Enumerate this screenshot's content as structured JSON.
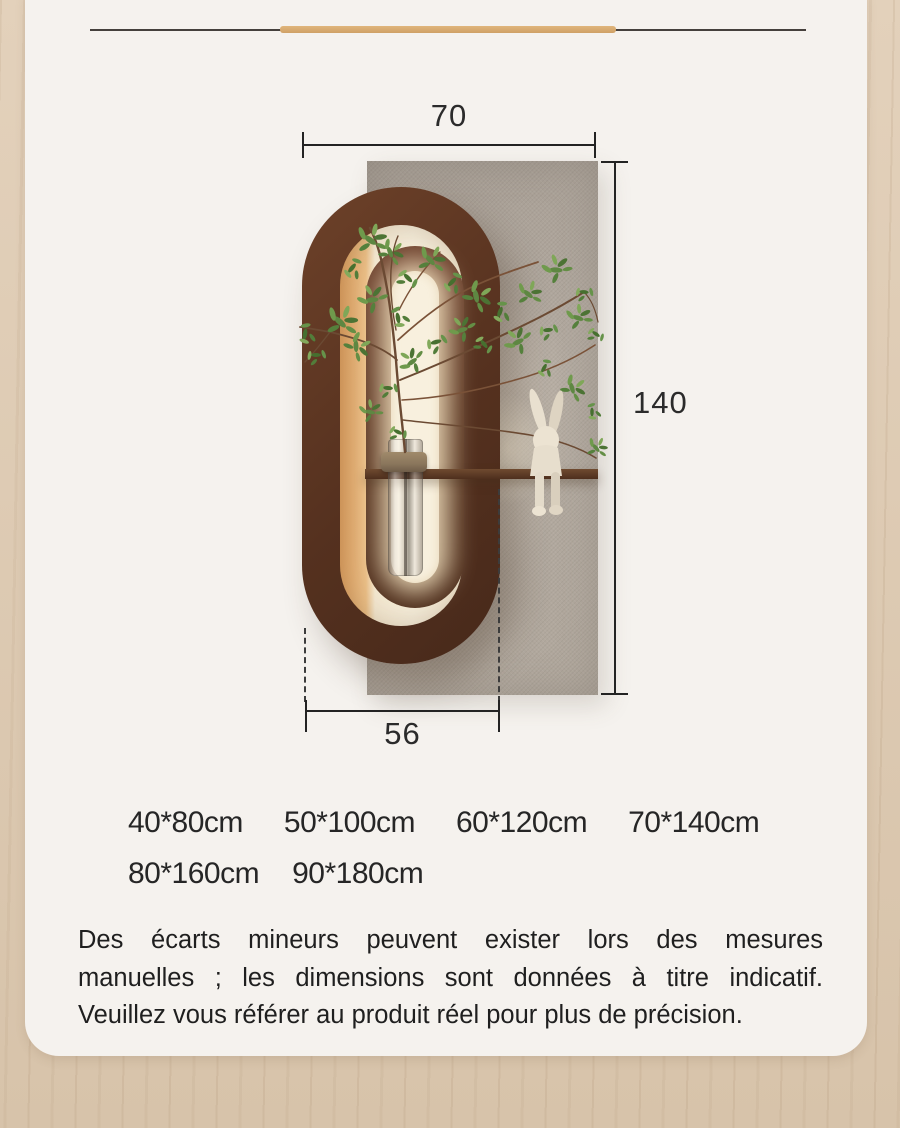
{
  "colors": {
    "accent_bar": "#d7a96f",
    "wood_edge": "#ddcbb4",
    "card_bg": "#f5f2ee",
    "frame_brown": "#5a3423",
    "panel_gray": "#aea59b",
    "text": "#222222"
  },
  "diagram": {
    "width_label": "70",
    "height_label": "140",
    "shelf_width_label": "56"
  },
  "sizes": {
    "row1": [
      "40*80cm",
      "50*100cm",
      "60*120cm",
      "70*140cm"
    ],
    "row2": [
      "80*160cm",
      "90*180cm"
    ]
  },
  "disclaimer": {
    "line1": "Des écarts mineurs peuvent exister lors des mesures",
    "line2": "manuelles ; les dimensions sont données à titre indicatif.",
    "line3": "Veuillez vous référer au produit réel pour plus de précision."
  }
}
